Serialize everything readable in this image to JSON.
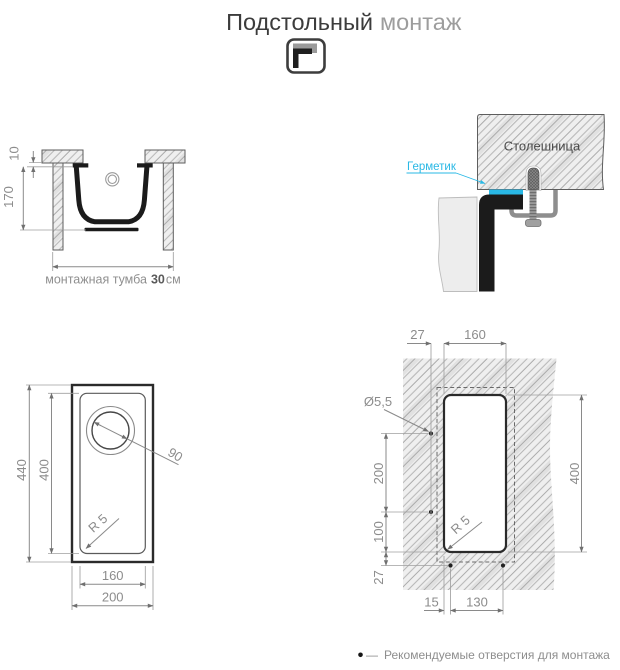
{
  "title": {
    "main": "Подстольный",
    "sub": "монтаж"
  },
  "cross_section": {
    "dim_rim_gap": "10",
    "dim_depth": "170",
    "caption_text": "монтажная тумба",
    "caption_value": "30",
    "caption_unit": "см"
  },
  "detail": {
    "countertop_label": "Столешница",
    "sealant_label": "Герметик",
    "sealant_color": "#29b8e5"
  },
  "top_view": {
    "dim_outer_height": "440",
    "dim_inner_height": "400",
    "dim_drain_diameter": "90",
    "dim_corner_radius": "R 5",
    "dim_inner_width": "160",
    "dim_outer_width": "200"
  },
  "template": {
    "dim_hole_offset_top": "27",
    "dim_cutout_width": "160",
    "dim_hole_diameter": "Ø5,5",
    "dim_hole_spacing_left": "200",
    "dim_hole_to_corner": "100",
    "dim_corner_to_holes_row": "27",
    "dim_cutout_height": "400",
    "dim_edge_to_hole": "15",
    "dim_holes_spacing_bottom": "130",
    "dim_corner_radius": "R 5"
  },
  "legend": {
    "dash": "—",
    "text": "Рекомендуемые отверстия для монтажа"
  }
}
